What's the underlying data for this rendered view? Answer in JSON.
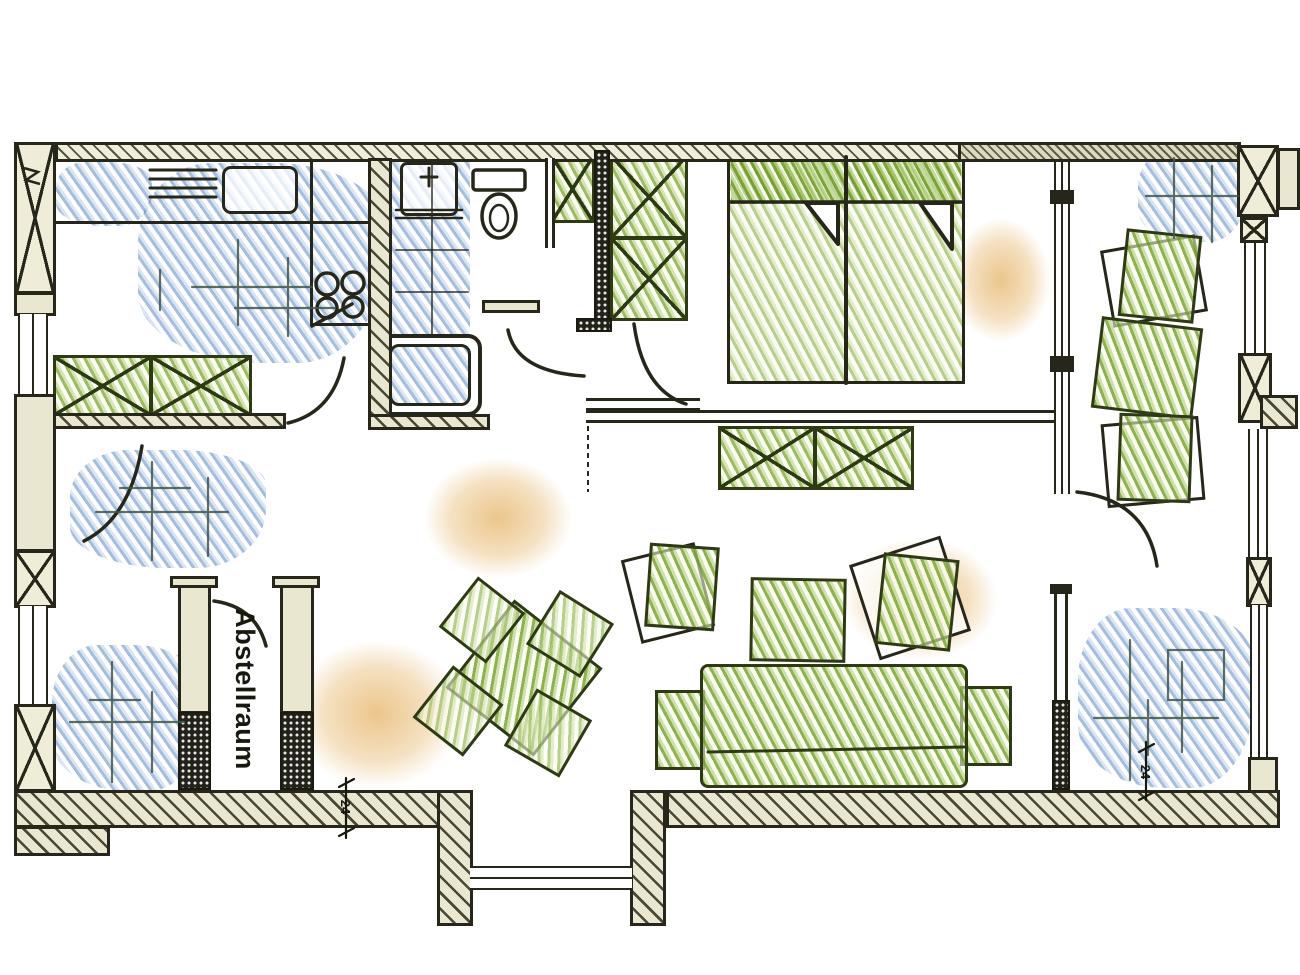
{
  "document": {
    "type": "hand-drawn apartment floor plan",
    "labels": {
      "storage_room": "Abstellraum",
      "dimension_bottom_left": "24",
      "dimension_bottom_right": "24"
    },
    "palette": {
      "paper": "#ffffff",
      "ink": "#26261a",
      "wall_fill": "#eae7d0",
      "furniture_green": "#85b23e",
      "shading_blue": "#5d8ec4",
      "shading_orange": "#dda24a"
    },
    "symbols": [
      "masonry-pillar",
      "window",
      "bay-window",
      "door-swing",
      "kitchen-counter",
      "kitchen-sink",
      "stove-hotplates",
      "sideboard",
      "washbasin",
      "toilet",
      "bathtub",
      "hall-wardrobe",
      "double-bed",
      "pillows",
      "rug",
      "dining-table",
      "chair",
      "armchair",
      "coffee-table",
      "sofa",
      "storage-room",
      "dimension-mark"
    ]
  }
}
